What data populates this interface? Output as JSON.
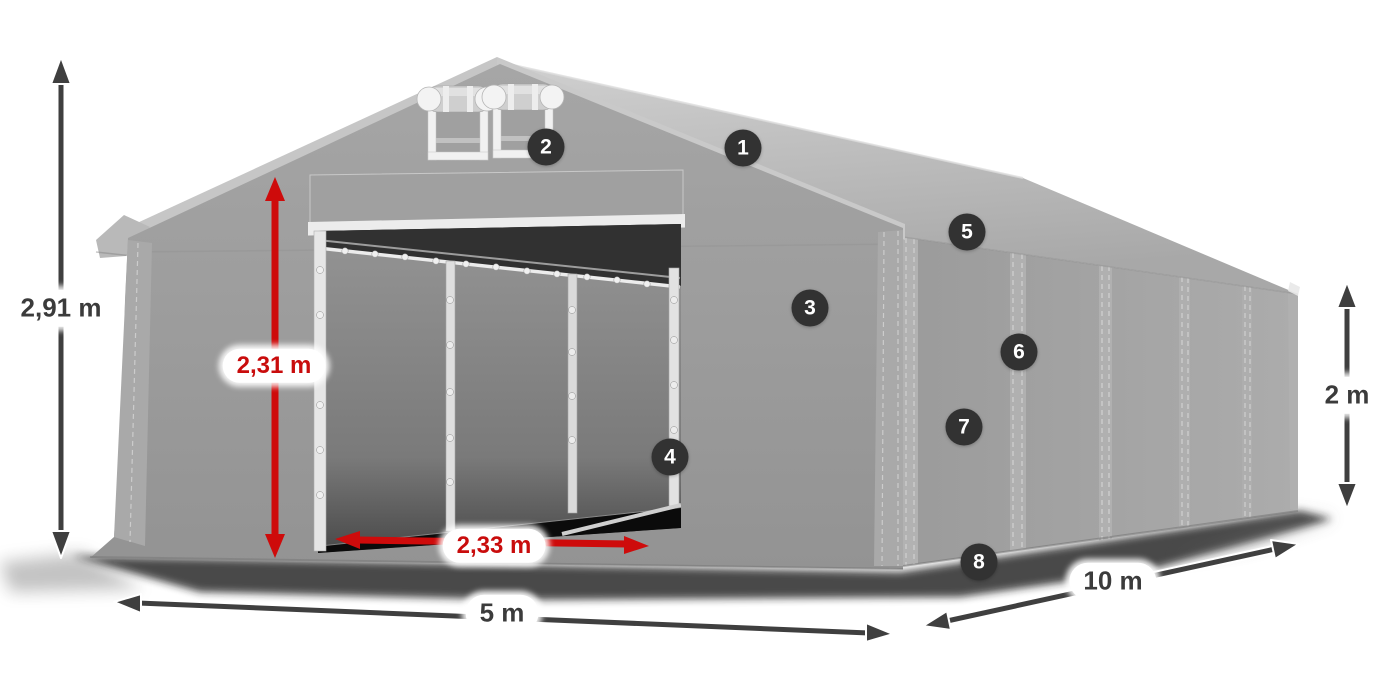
{
  "measurements": {
    "total_height": {
      "label": "2,91 m",
      "style": "dark"
    },
    "door_height": {
      "label": "2,31 m",
      "style": "red"
    },
    "door_width": {
      "label": "2,33 m",
      "style": "red"
    },
    "front_width": {
      "label": "5 m",
      "style": "dark"
    },
    "side_length": {
      "label": "10 m",
      "style": "dark"
    },
    "wall_height": {
      "label": "2 m",
      "style": "dark"
    }
  },
  "hotspots": [
    {
      "label": "1"
    },
    {
      "label": "2"
    },
    {
      "label": "3"
    },
    {
      "label": "4"
    },
    {
      "label": "5"
    },
    {
      "label": "6"
    },
    {
      "label": "7"
    },
    {
      "label": "8"
    }
  ],
  "colors": {
    "background": "#ffffff",
    "dimension_red": "#ce0b0b",
    "dimension_dark": "#3f3f3f",
    "label_background": "#ffffff",
    "label_text_dark": "#3b3b3b",
    "label_text_red": "#c90c0c",
    "hotspot_background": "#323232",
    "hotspot_text": "#ffffff",
    "tent_roof_gray": "#c6c6c6",
    "tent_gable_gray": "#9a9a9a",
    "tent_side_gray": "#a3a3a3",
    "tent_frame_white": "#ededed",
    "interior_dark": "#2e2e2e"
  }
}
